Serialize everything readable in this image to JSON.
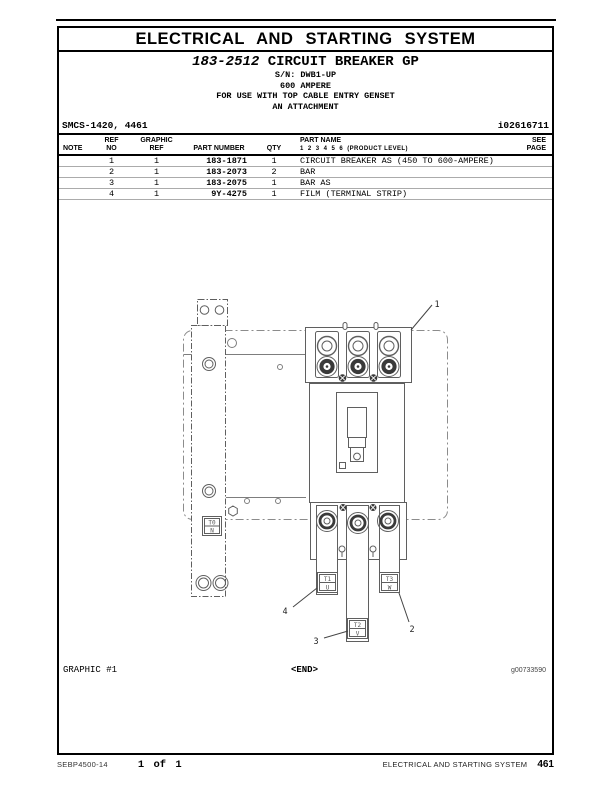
{
  "banner": {
    "title": "ELECTRICAL AND STARTING SYSTEM"
  },
  "title_block": {
    "part_number": "183-2512",
    "group_name": "CIRCUIT BREAKER GP",
    "serial_range": "S/N: DWB1-UP",
    "rating": "600 AMPERE",
    "usage_note": "FOR USE WITH TOP CABLE ENTRY GENSET",
    "attachment_note": "AN ATTACHMENT"
  },
  "meta": {
    "smcs_code": "SMCS-1420, 4461",
    "doc_id": "i02616711"
  },
  "parts_table": {
    "headers": {
      "note": "NOTE",
      "ref_line1": "REF",
      "ref_line2": "NO",
      "graphic_line1": "GRAPHIC",
      "graphic_line2": "REF",
      "part_number": "PART NUMBER",
      "qty": "QTY",
      "part_name": "PART NAME",
      "product_level": "1  2  3  4  5  6  (PRODUCT LEVEL)",
      "see_line1": "SEE",
      "see_line2": "PAGE"
    },
    "rows": [
      {
        "note": "",
        "ref_no": "1",
        "graphic_ref": "1",
        "part_number": "183-1871",
        "qty": "1",
        "part_name": "CIRCUIT BREAKER AS (450 TO 600-AMPERE)",
        "see_page": ""
      },
      {
        "note": "",
        "ref_no": "2",
        "graphic_ref": "1",
        "part_number": "183-2073",
        "qty": "2",
        "part_name": "BAR",
        "see_page": ""
      },
      {
        "note": "",
        "ref_no": "3",
        "graphic_ref": "1",
        "part_number": "183-2075",
        "qty": "1",
        "part_name": "BAR AS",
        "see_page": ""
      },
      {
        "note": "",
        "ref_no": "4",
        "graphic_ref": "1",
        "part_number": "9Y-4275",
        "qty": "1",
        "part_name": "FILM (TERMINAL STRIP)",
        "see_page": ""
      }
    ]
  },
  "diagram": {
    "caption": "GRAPHIC #1",
    "end_marker": "<END>",
    "graphic_id": "g00733590",
    "callouts": [
      "1",
      "2",
      "3",
      "4"
    ],
    "terminal_labels": {
      "t0_top": "T0",
      "t0_bottom": "N",
      "t1_top": "T1",
      "t1_bottom": "U",
      "t2_top": "T2",
      "t2_bottom": "V",
      "t3_top": "T3",
      "t3_bottom": "W"
    }
  },
  "footer": {
    "publication": "SEBP4500-14",
    "page_indicator": "1 of 1",
    "section": "ELECTRICAL AND STARTING SYSTEM",
    "page_number": "461"
  },
  "colors": {
    "ink": "#000000",
    "diagram_line": "#5f5f5f",
    "row_divider": "#ababab"
  }
}
